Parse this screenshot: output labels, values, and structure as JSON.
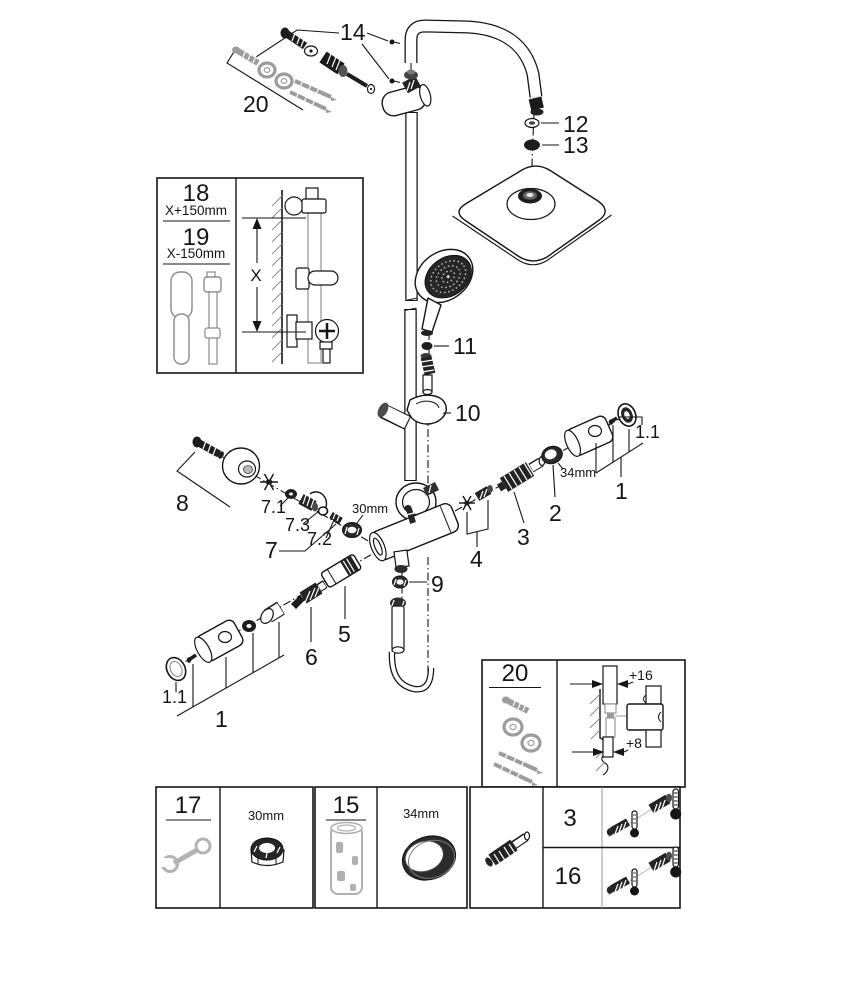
{
  "figure": {
    "callouts": {
      "n14": "14",
      "n20_top": "20",
      "n12": "12",
      "n13": "13",
      "n11": "11",
      "n10": "10",
      "n1_right": "1",
      "n1_1_right": "1.1",
      "n2": "2",
      "n3": "3",
      "mm34_right": "34mm",
      "n4": "4",
      "n9": "9",
      "n8": "8",
      "n7": "7",
      "n7_1": "7.1",
      "n7_2": "7.2",
      "n7_3": "7.3",
      "mm30_mid": "30mm",
      "n5": "5",
      "n6": "6",
      "n1_bottom": "1",
      "n1_1_bottom": "1.1"
    },
    "inset_length": {
      "part_upper": "18",
      "dim_upper": "X+150mm",
      "part_lower": "19",
      "dim_lower": "X-150mm",
      "axis": "X"
    },
    "inset_mount": {
      "part": "20",
      "offset_top": "+16",
      "offset_bottom": "+8"
    },
    "spares_row": {
      "tool_wrench": "17",
      "nut_size": "30mm",
      "tool_socket": "15",
      "ring_size": "34mm",
      "part_a": "3",
      "part_b": "16"
    }
  }
}
